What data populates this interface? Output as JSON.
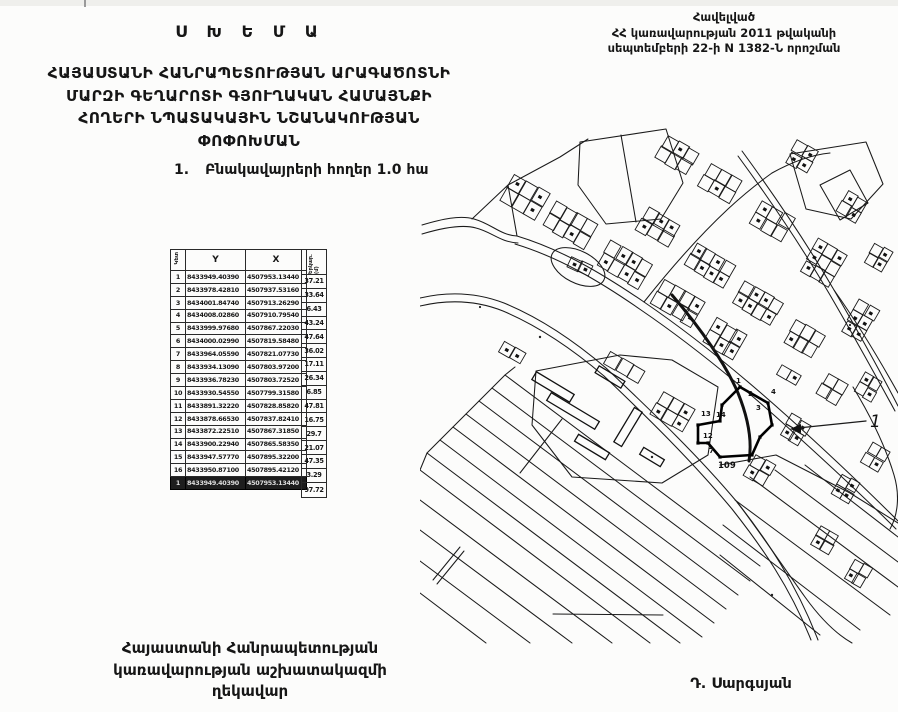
{
  "title": "Ս Խ Ե Մ Ա",
  "header_right": {
    "lines": [
      "Հավելված",
      "ՀՀ կառավարության 2011 թվականի",
      "սեպտեմբերի 22-ի N 1382-Ն որոշման"
    ]
  },
  "subtitle_lines": [
    "ՀԱՅԱՍՏԱՆԻ ՀԱՆՐԱՊԵՏՈՒԹՅԱՆ ԱՐԱԳԱԾՈՏՆԻ",
    "ՄԱՐԶԻ ԳԵՂԱՐՈՏԻ ԳՅՈՒՂԱԿԱՆ ՀԱՄԱՅՆՔԻ",
    "ՀՈՂԵՐԻ ՆՊԱՏԱԿԱՅԻՆ ՆՇԱՆԱԿՈՒԹՅԱՆ",
    "ՓՈՓՈԽՄԱՆ"
  ],
  "list_item": {
    "number": "1.",
    "text": "Բնակավայրերի հողեր 1.0 հա"
  },
  "table": {
    "col_headers": {
      "point": "Կետ",
      "y": "Y",
      "x": "X",
      "length": "Երկար. (մ)"
    },
    "rows": [
      {
        "n": "1",
        "y": "8433949.40390",
        "x": "4507953.13440"
      },
      {
        "n": "2",
        "y": "8433978.42810",
        "x": "4507937.53160"
      },
      {
        "n": "3",
        "y": "8434001.84740",
        "x": "4507913.26290"
      },
      {
        "n": "4",
        "y": "8434008.02860",
        "x": "4507910.79540"
      },
      {
        "n": "5",
        "y": "8433999.97680",
        "x": "4507867.22030"
      },
      {
        "n": "6",
        "y": "8434000.02990",
        "x": "4507819.58480"
      },
      {
        "n": "7",
        "y": "8433964.05590",
        "x": "4507821.07730"
      },
      {
        "n": "8",
        "y": "8433934.13090",
        "x": "4507803.97200"
      },
      {
        "n": "9",
        "y": "8433936.78230",
        "x": "4507803.72520"
      },
      {
        "n": "10",
        "y": "8433930.54550",
        "x": "4507799.31580"
      },
      {
        "n": "11",
        "y": "8433891.32220",
        "x": "4507828.85820"
      },
      {
        "n": "12",
        "y": "8433878.66530",
        "x": "4507837.82410"
      },
      {
        "n": "13",
        "y": "8433872.22510",
        "x": "4507867.31850"
      },
      {
        "n": "14",
        "y": "8433900.22940",
        "x": "4507865.58350"
      },
      {
        "n": "15",
        "y": "8433947.57770",
        "x": "4507895.32200"
      },
      {
        "n": "16",
        "y": "8433950.87100",
        "x": "4507895.42120"
      },
      {
        "n": "1",
        "y": "8433949.40390",
        "x": "4507953.13440",
        "closing": true
      }
    ],
    "lengths": [
      "37.21",
      "33.64",
      "6.43",
      "43.24",
      "47.64",
      "36.02",
      "17.11",
      "26.34",
      "6.85",
      "47.81",
      "16.75",
      "29.7",
      "21.07",
      "47.35",
      "3.29",
      "97.72"
    ]
  },
  "map": {
    "callout_label": "1",
    "area_label": "109",
    "point_labels": [
      "1",
      "2",
      "3",
      "4",
      "14",
      "13",
      "12",
      "7"
    ]
  },
  "footer": {
    "left_lines": [
      "Հայաստանի Հանրապետության",
      "կառավարության աշխատակազմի",
      "ղեկավար"
    ],
    "signature": "Դ. Սարգսյան"
  }
}
